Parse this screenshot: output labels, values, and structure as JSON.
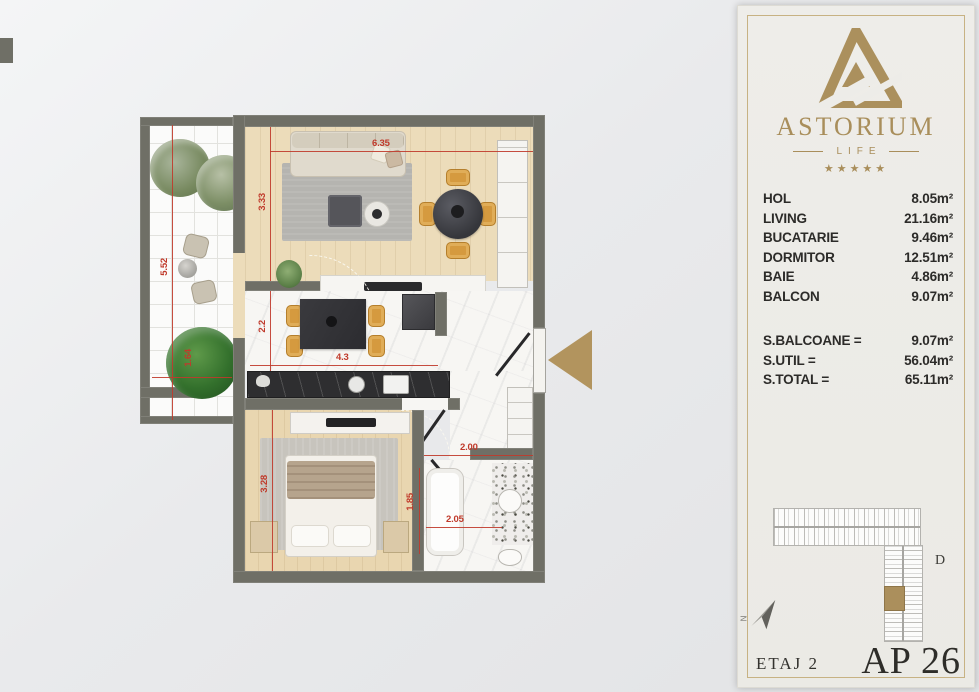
{
  "colors": {
    "accent_gold": "#ab905d",
    "dimension_red": "#c03a2b",
    "wall_gray": "#6f6f66"
  },
  "panel": {
    "brand": {
      "name": "ASTORIUM",
      "tagline": "LIFE",
      "stars": "★★★★★"
    },
    "rooms": [
      {
        "label": "HOL",
        "value": "8.05m²"
      },
      {
        "label": "LIVING",
        "value": "21.16m²"
      },
      {
        "label": "BUCATARIE",
        "value": "9.46m²"
      },
      {
        "label": "DORMITOR",
        "value": "12.51m²"
      },
      {
        "label": "BAIE",
        "value": "4.86m²"
      },
      {
        "label": "BALCON",
        "value": "9.07m²"
      }
    ],
    "totals": [
      {
        "label": "S.BALCOANE =",
        "value": "9.07m²"
      },
      {
        "label": "S.UTIL =",
        "value": "56.04m²"
      },
      {
        "label": "S.TOTAL =",
        "value": "65.11m²"
      }
    ],
    "building_label": "D",
    "north_label": "N",
    "floor_label": "ETAJ 2",
    "apartment_label": "AP 26"
  },
  "plan": {
    "dims": [
      "6.35",
      "3.33",
      "2.2",
      "4.3",
      "3.28",
      "5.52",
      "1.64",
      "2.00",
      "1.85",
      "2.05"
    ]
  }
}
